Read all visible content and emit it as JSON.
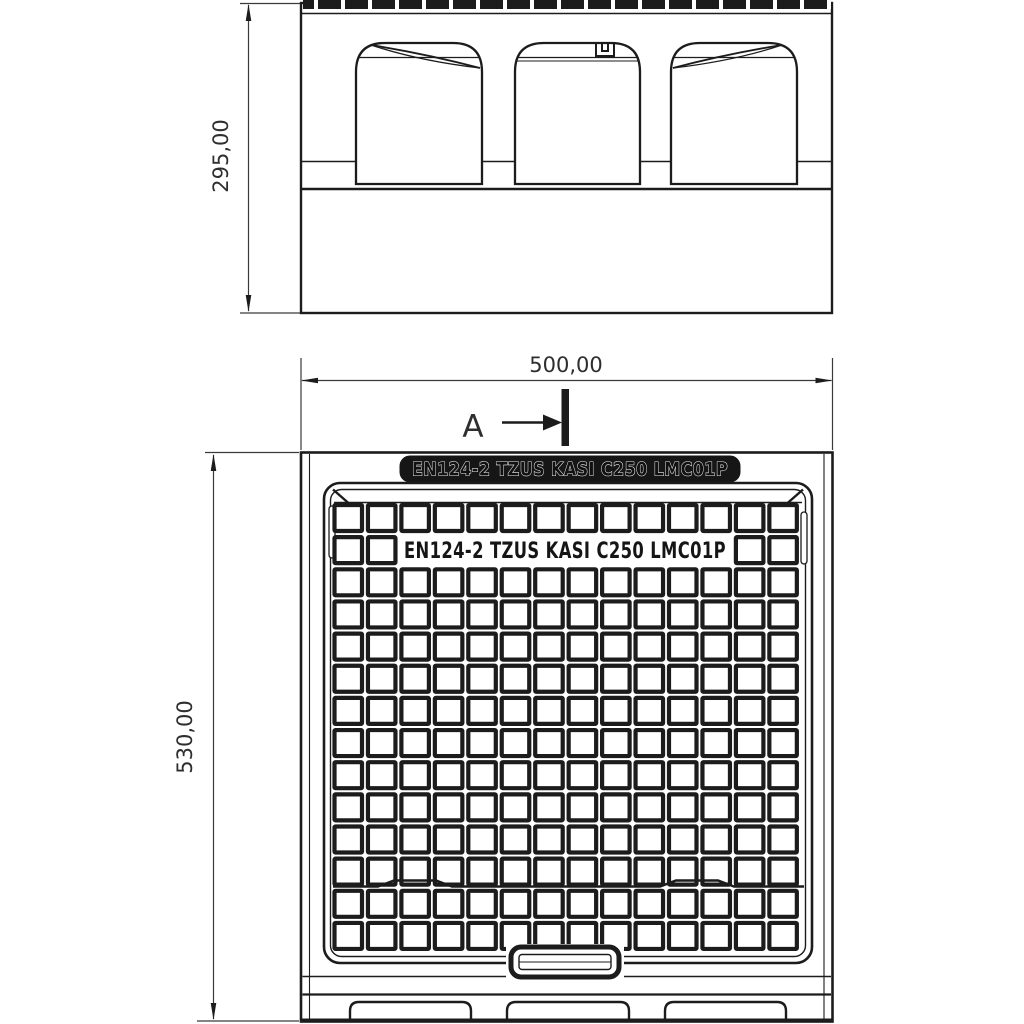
{
  "drawing": {
    "colors": {
      "ink": "#1c1c1c",
      "background": "#ffffff",
      "dim_text": "#2e2e2e"
    },
    "plan": {
      "band_text": "EN124-2 TZUS KASI C250 LMC01P",
      "cover_text": "EN124-2 TZUS KASI C250 LMC01P"
    },
    "dimensions": {
      "side_height": "295,00",
      "plan_width": "500,00",
      "plan_height": "530,00"
    },
    "section": {
      "label": "A"
    }
  }
}
